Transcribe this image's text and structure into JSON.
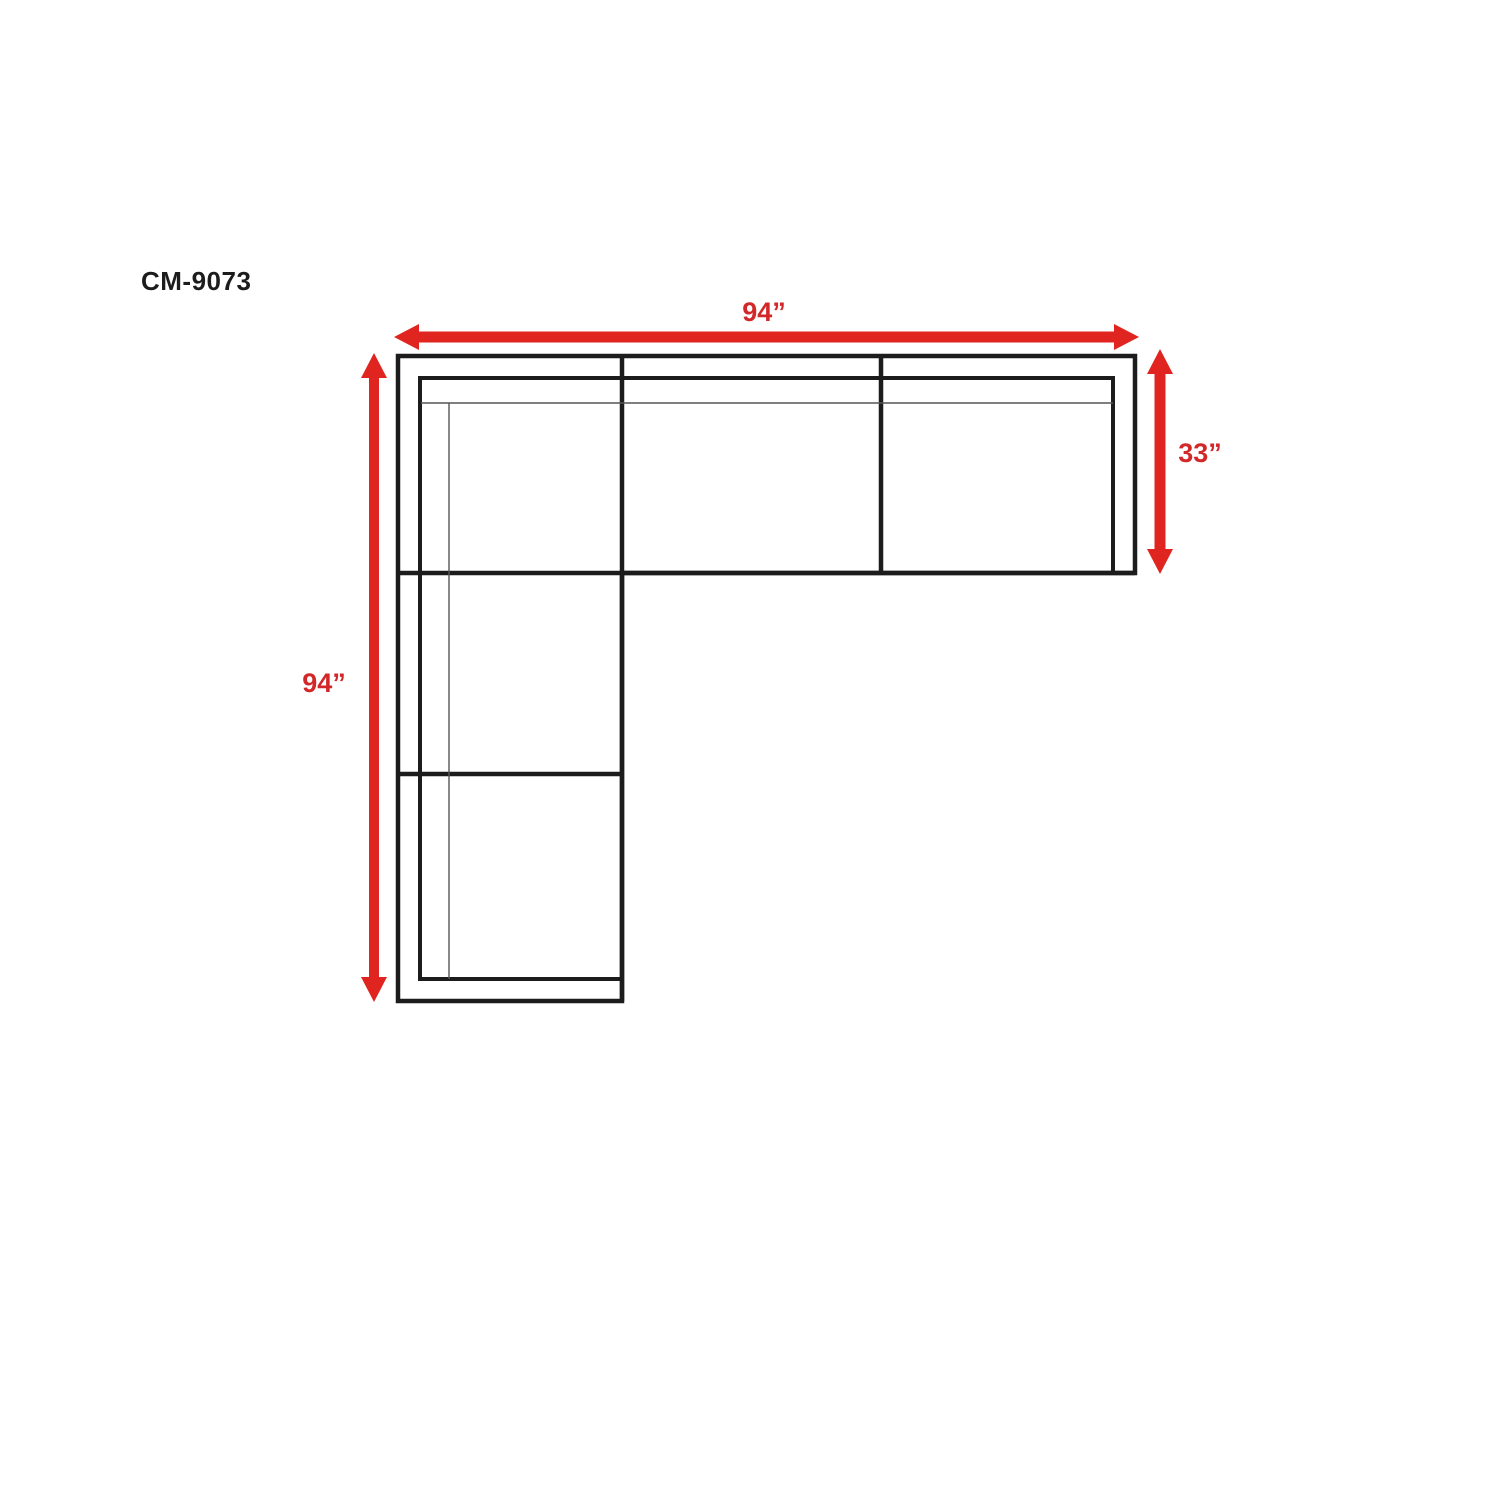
{
  "diagram": {
    "model_label": "CM-9073",
    "dimensions": {
      "top_width": "94”",
      "right_depth": "33”",
      "left_length": "94”"
    },
    "colors": {
      "outline_black": "#1c1c1c",
      "cushion_line_gray": "#555555",
      "dimension_arrow_red": "#e02520",
      "dimension_label_red": "#d3282a",
      "background": "#ffffff"
    }
  }
}
